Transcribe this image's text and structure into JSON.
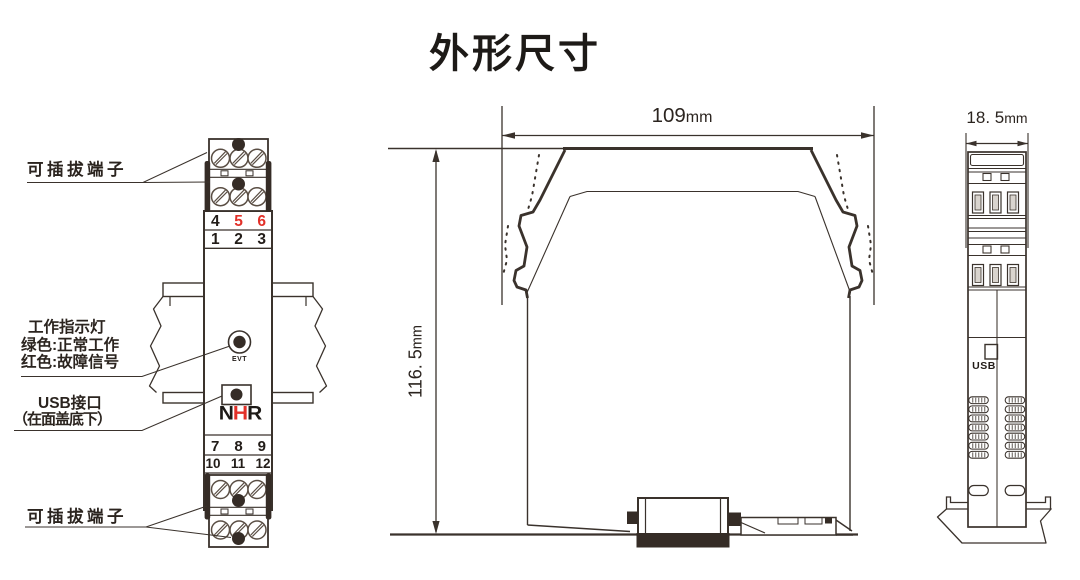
{
  "title": "外形尺寸",
  "colors": {
    "line": "#3a322c",
    "red": "#e23028",
    "fill_dark": "#352c26"
  },
  "front_view": {
    "label_plug_top": "可插拔端子",
    "label_plug_bottom": "可插拔端子",
    "indicator": {
      "line1": "工作指示灯",
      "line2": "绿色:正常工作",
      "line3": "红色:故障信号"
    },
    "usb": {
      "line1": "USB接口",
      "line2": "（在面盖底下）"
    },
    "led_label": "EVT",
    "logo": {
      "n": "N",
      "h": "H",
      "r": "R"
    },
    "terminals": {
      "row_456": [
        "4",
        "5",
        "6"
      ],
      "row_123": [
        "1",
        "2",
        "3"
      ],
      "row_789": [
        "7",
        "8",
        "9"
      ],
      "row_101112": [
        "10",
        "11",
        "12"
      ]
    }
  },
  "side_view": {
    "width_value": "109",
    "width_unit": "mm",
    "height_value": "116. 5",
    "height_unit": "mm"
  },
  "end_view": {
    "depth_value": "18. 5",
    "depth_unit": "mm",
    "usb_label": "USB"
  }
}
